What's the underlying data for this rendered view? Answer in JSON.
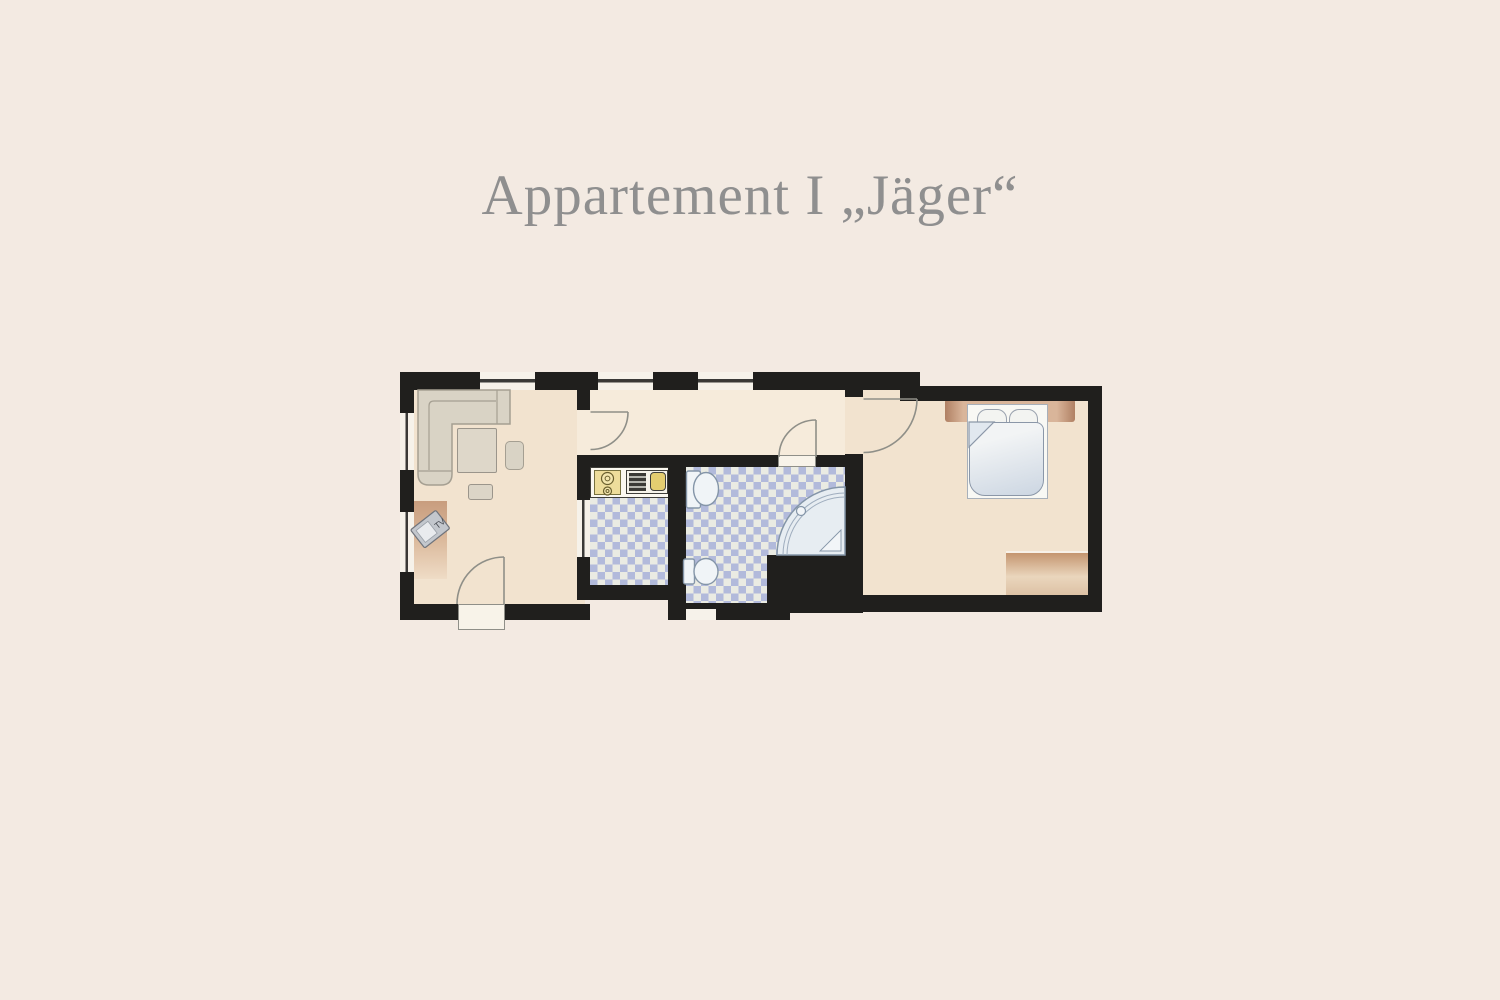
{
  "page": {
    "title": "Appartement I „Jäger“",
    "title_color": "#8f8f8f",
    "background_color": "#f3eae2"
  },
  "floorplan": {
    "tv_label": "TV",
    "colors": {
      "wall": "#201f1d",
      "room_floor": "#f2e3cf",
      "hallway_floor": "#f6ebdb",
      "tile_blue": "#b2badb",
      "tile_white": "#eaebe3",
      "fixture_outline": "#8495a8",
      "fixture_fill": "#f0f4f7",
      "door_line": "#8f8f88",
      "furniture_tan_dark": "#c4956f",
      "furniture_tan_light": "#ead6bd",
      "sofa_fill": "#d9d3c5",
      "sofa_outline": "#a59f92",
      "counter_yellow": "#eedd9b",
      "sink_yellow": "#e4cd70"
    }
  }
}
